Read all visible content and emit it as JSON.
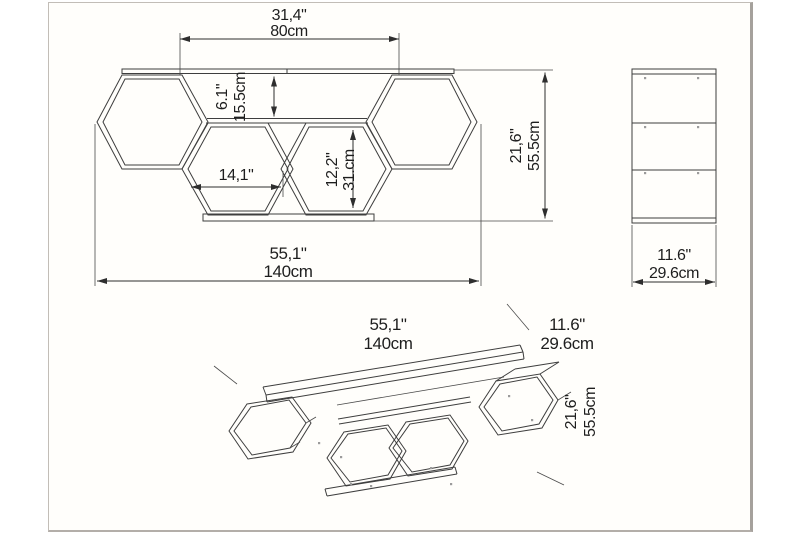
{
  "views": {
    "front": {
      "shelf_top_width_in": "31,4\"",
      "shelf_top_width_cm": "80cm",
      "top_gap_in": "6.1\"",
      "top_gap_cm": "15.5cm",
      "cubby_width_in": "14,1\"",
      "cubby_height_in": "12,2\"",
      "cubby_height_cm": "31.cm",
      "height_in": "21,6\"",
      "height_cm": "55.5cm",
      "width_in": "55,1\"",
      "width_cm": "140cm"
    },
    "side": {
      "depth_in": "11.6\"",
      "depth_cm": "29.6cm"
    },
    "perspective": {
      "width_in": "55,1\"",
      "width_cm": "140cm",
      "depth_in": "11.6\"",
      "depth_cm": "29.6cm",
      "height_in": "21,6\"",
      "height_cm": "55.5cm"
    }
  },
  "colors": {
    "line": "#3e3e3e",
    "text": "#1e1e1e",
    "frame": "#b5b0aa",
    "paper": "#fffefb",
    "dot": "#9b9b9b"
  }
}
